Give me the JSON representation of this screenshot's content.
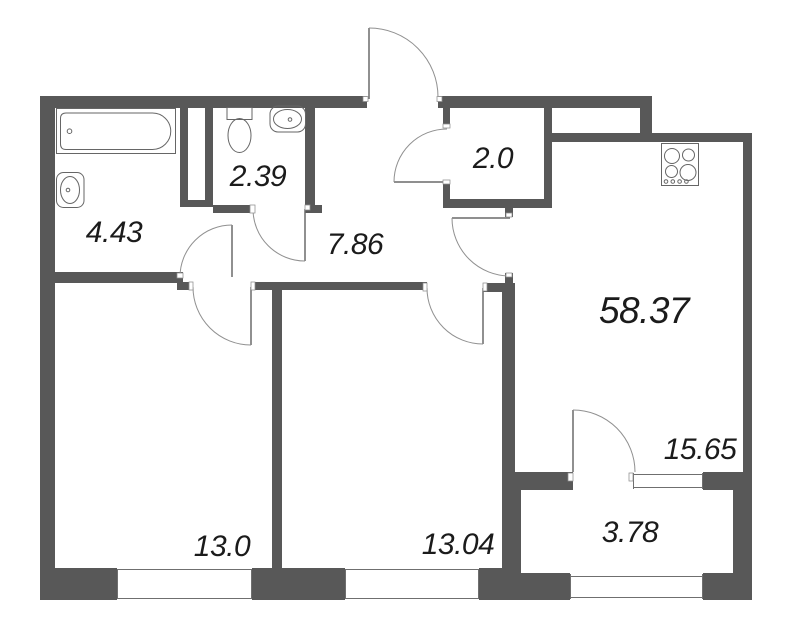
{
  "rooms": {
    "bathroom": {
      "area": "4.43"
    },
    "toilet": {
      "area": "2.39"
    },
    "hallway": {
      "area": "7.86"
    },
    "closet": {
      "area": "2.0"
    },
    "living_kitchen": {
      "area": "58.37"
    },
    "kitchen_zone": {
      "area": "15.65"
    },
    "balcony": {
      "area": "3.78"
    },
    "bedroom_left": {
      "area": "13.0"
    },
    "bedroom_middle": {
      "area": "13.04"
    }
  },
  "icons": {
    "bathtub": "bathtub-icon",
    "bathroom_sink": "sink-icon",
    "toilet": "toilet-icon",
    "toilet_sink": "sink-icon",
    "stove": "stove-icon"
  },
  "colors": {
    "wall": "#585858",
    "line": "#6f6f6f",
    "arc": "#909090",
    "fixture": "#666666",
    "text": "#1b1b1b",
    "bg": "#ffffff"
  }
}
